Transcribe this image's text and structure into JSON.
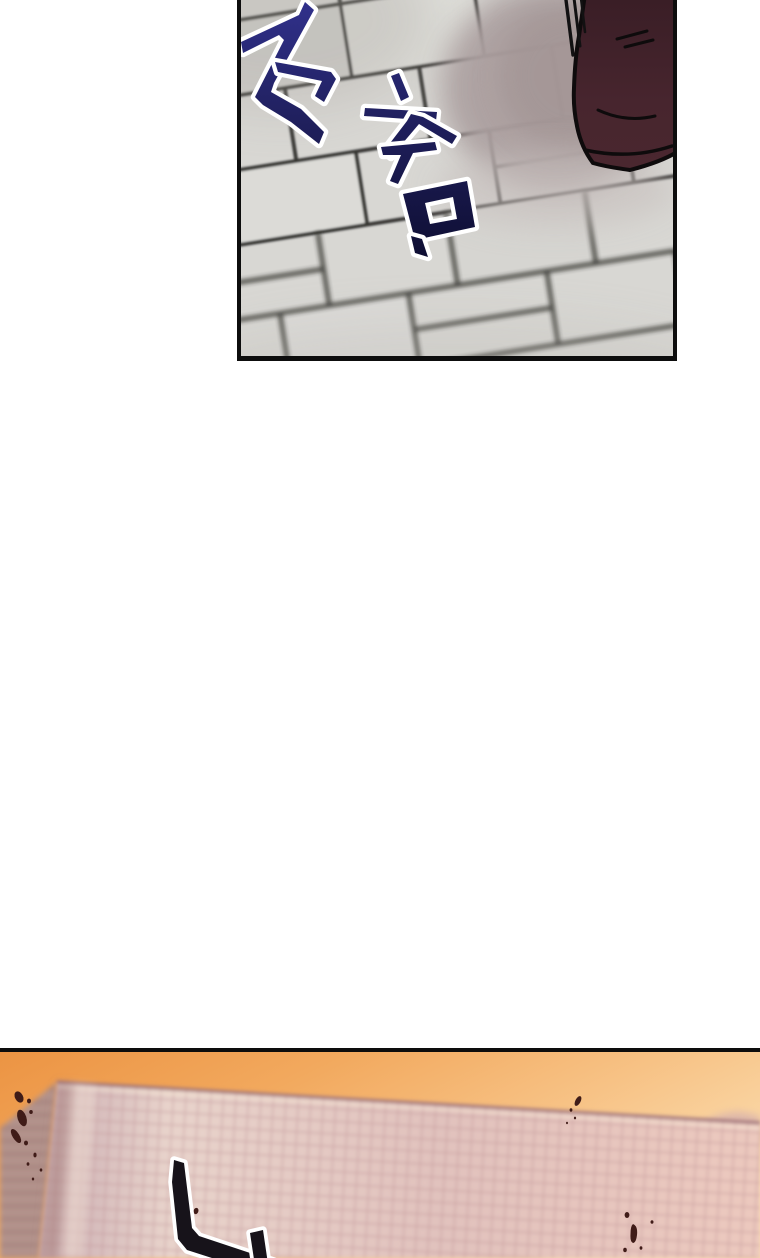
{
  "page": {
    "background_color": "#ffffff",
    "kind": "vertical webtoon comic page"
  },
  "panels": [
    {
      "name": "top-panel",
      "sfx_text": "주춤",
      "sfx_fill_color": "#23236b",
      "sfx_outline_color": "#ffffff",
      "artwork": {
        "subject": "boot stepping on tiled floor with cast shadow and motion lines",
        "tile_color": "#d8d7d3",
        "grout_color": "#2b2a28",
        "shadow_color": "#aca0a0",
        "boot_color": "#45242c",
        "ink_color": "#0e0b0c",
        "border_color": "#0d0d0d"
      }
    },
    {
      "name": "bottom-panel",
      "sfx_text": "니",
      "sfx_truncated": true,
      "sfx_fill_color": "#17131a",
      "sfx_outline_color": "#ffffff",
      "artwork": {
        "subject": "high-rise building facade against sunset sky with dark splatter specks",
        "sky_gradient": [
          "#ec9443",
          "#f2a95e",
          "#f7c285",
          "#fbdcae"
        ],
        "building_face_color": "#e3c6c0",
        "building_grid_color": "#bd8e94",
        "building_side_color": "#c2a29c",
        "speckle_color": "#401c18",
        "border_color": "#0d0d0d"
      }
    }
  ]
}
